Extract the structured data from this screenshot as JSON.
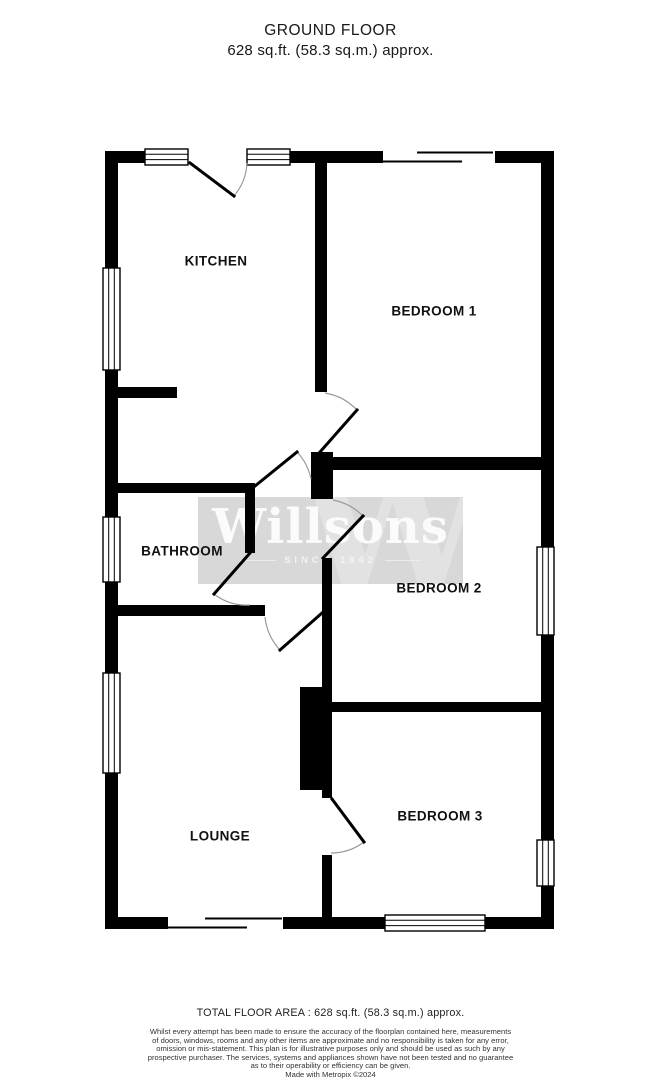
{
  "header": {
    "title": "GROUND FLOOR",
    "subtitle": "628 sq.ft. (58.3 sq.m.) approx."
  },
  "watermark": {
    "brand": "Willsons",
    "tagline": "SINCE 1842",
    "monogram": "W"
  },
  "rooms": {
    "kitchen": "KITCHEN",
    "bedroom1": "BEDROOM 1",
    "bathroom": "BATHROOM",
    "bedroom2": "BEDROOM 2",
    "lounge": "LOUNGE",
    "bedroom3": "BEDROOM 3"
  },
  "footer": {
    "total_area": "TOTAL FLOOR AREA : 628 sq.ft. (58.3 sq.m.) approx.",
    "disclaimer_lines": [
      "Whilst every attempt has been made to ensure the accuracy of the floorplan contained here, measurements",
      "of doors, windows, rooms and any other items are approximate and no responsibility is taken for any error,",
      "omission or mis-statement. This plan is for illustrative purposes only and should be used as such by any",
      "prospective purchaser. The services, systems and appliances shown have not been tested and no guarantee",
      "as to their operability or efficiency can be given."
    ],
    "credit": "Made with Metropix ©2024"
  },
  "colors": {
    "wall": "#000000",
    "door_arc": "#999999",
    "watermark_box": "#d8d8d8",
    "watermark_monogram": "#e2e2e2",
    "watermark_text": "#fbfbfb",
    "background": "#ffffff",
    "text": "#1a1a1a"
  }
}
